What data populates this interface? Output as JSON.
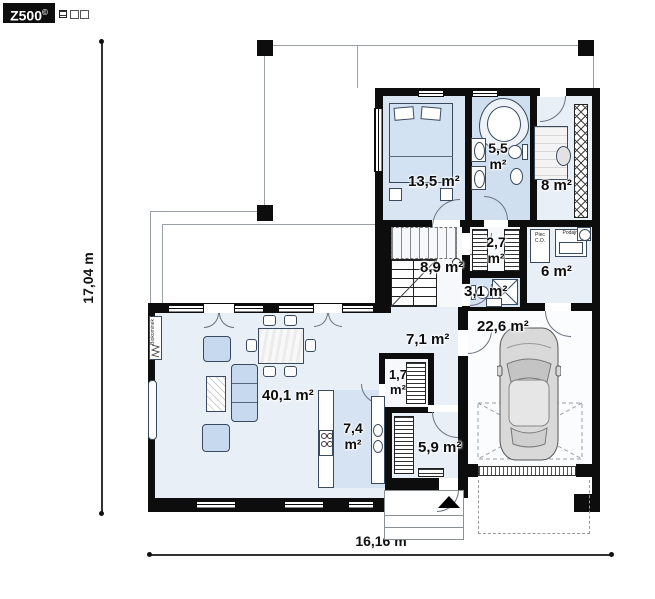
{
  "logo": {
    "brand": "Z500",
    "mark": "©"
  },
  "dimensions": {
    "total_width": "16,16 m",
    "total_height": "17,04 m"
  },
  "rooms": [
    {
      "name": "bedroom",
      "value": "13,5 m²"
    },
    {
      "name": "bathroom",
      "value": "5,5",
      "unit": "m²"
    },
    {
      "name": "office",
      "value": "8 m²"
    },
    {
      "name": "wardrobe",
      "value": "2,7",
      "unit": "m²"
    },
    {
      "name": "stair-hall",
      "value": "8,9 m²"
    },
    {
      "name": "toilet",
      "value": "3,1 m²"
    },
    {
      "name": "utility",
      "value": "6 m²"
    },
    {
      "name": "corridor",
      "value": "7,1 m²"
    },
    {
      "name": "garage",
      "value": "22,6 m²"
    },
    {
      "name": "living-room",
      "value": "40,1 m²"
    },
    {
      "name": "pantry",
      "value": "1,7",
      "unit": "m²"
    },
    {
      "name": "kitchen",
      "value": "7,4",
      "unit": "m²"
    },
    {
      "name": "entrance-hall",
      "value": "5,9 m²"
    }
  ],
  "equipment": {
    "boiler": "Piec C.O.",
    "feeder": "Podajn.",
    "fireplace": "Biokominek"
  },
  "colors": {
    "wall": "#0d0d0d",
    "floor_light": "#e9eff7",
    "floor_blue": "#d6e3f2",
    "furniture": "#c7d9ee"
  }
}
